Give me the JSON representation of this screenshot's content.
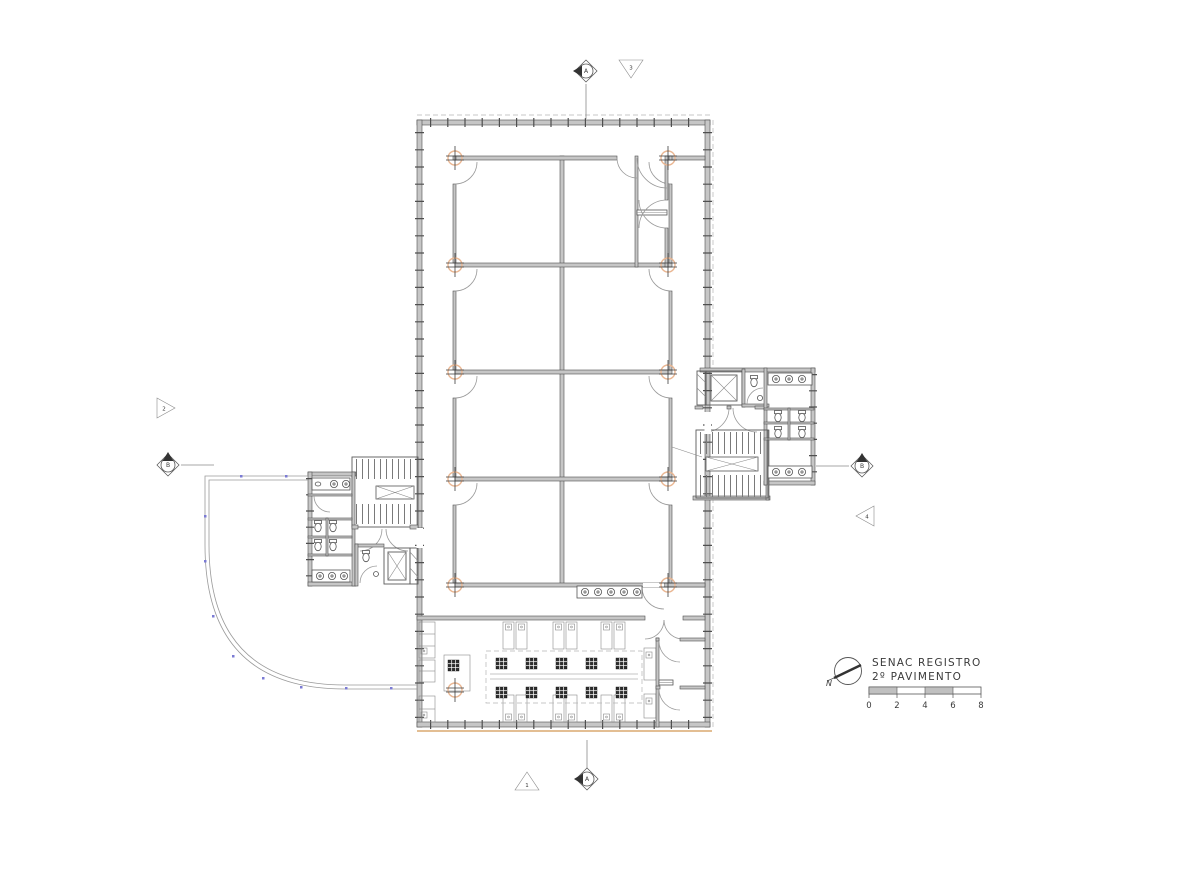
{
  "drawing": {
    "title_line1": "SENAC REGISTRO",
    "title_line2": "2º PAVIMENTO",
    "north_label": "N"
  },
  "scale_bar": {
    "ticks": [
      "0",
      "2",
      "4",
      "6",
      "8"
    ]
  },
  "markers": {
    "section_a_top": "A",
    "section_a_bottom": "A",
    "section_b_left": "B",
    "section_b_right": "B",
    "view_1_bottom": "1",
    "view_2_left": "2",
    "view_3_top": "3",
    "view_4_right": "4"
  },
  "colors": {
    "wall_fill": "#c6c6c6",
    "wall_edge": "#4f4f4f",
    "door_arc": "#9a9a9a",
    "column_marker": "#eab793",
    "terrace_tick": "#7b7bd4",
    "floor_edge": "#e3be93",
    "background": "#ffffff"
  }
}
